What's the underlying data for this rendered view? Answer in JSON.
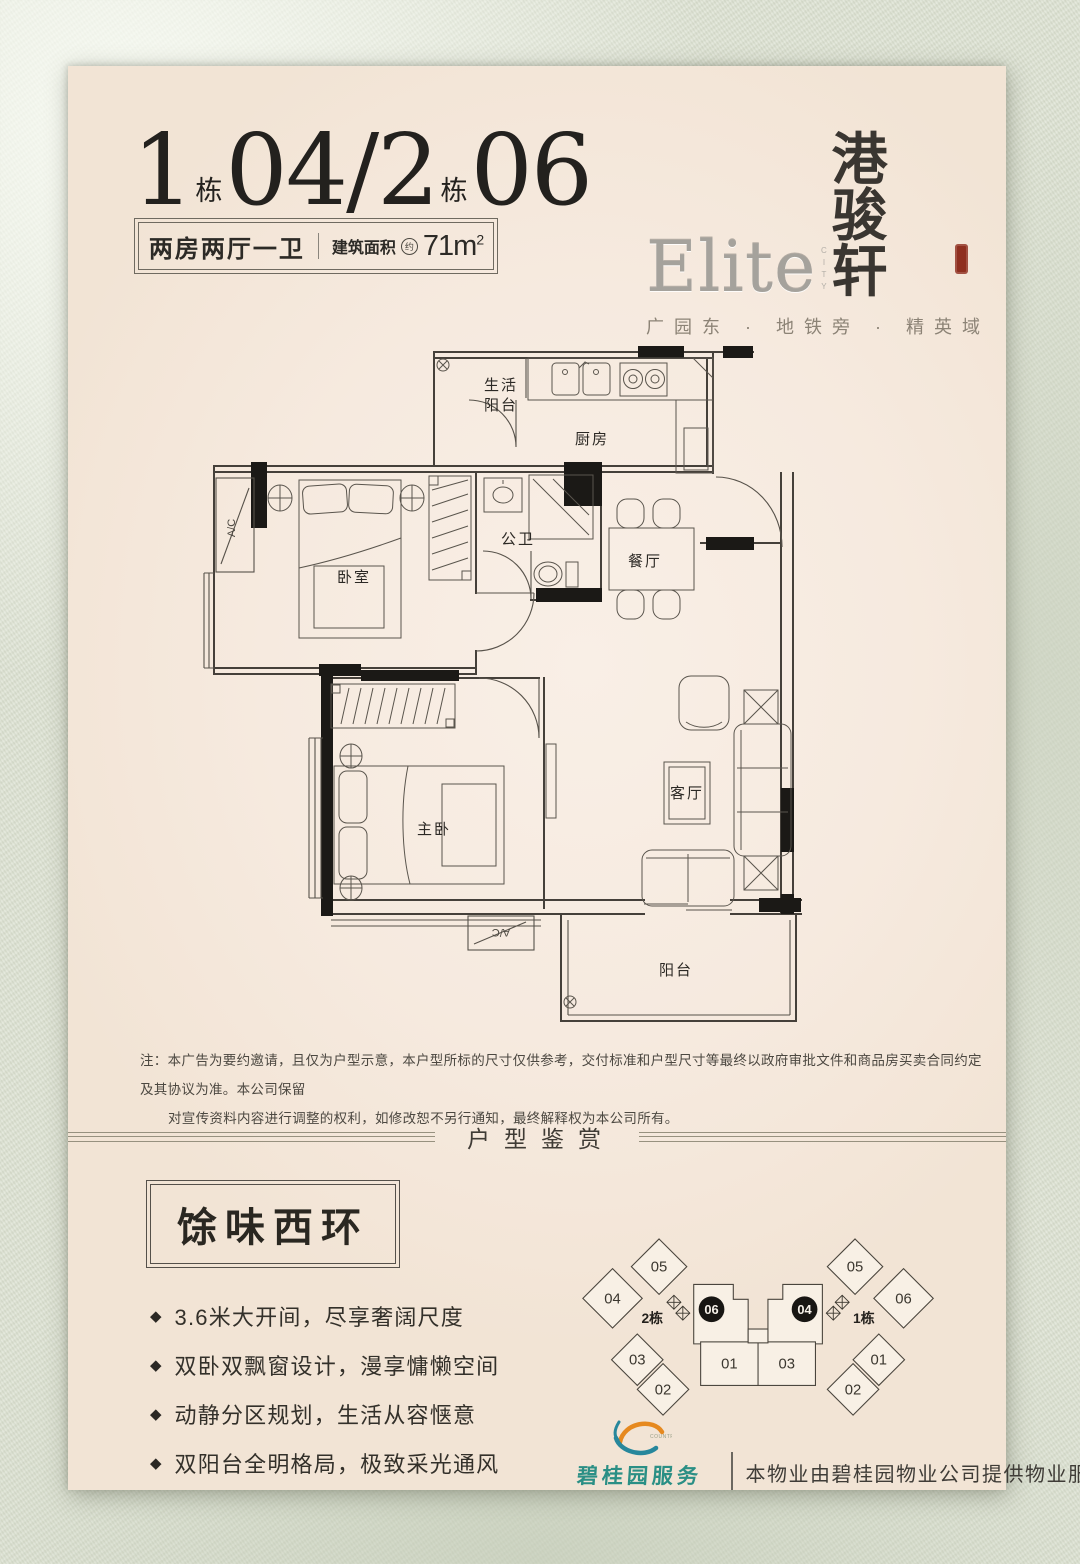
{
  "colors": {
    "page_cream": "#f8efe4",
    "fabric_green": "#dde2d2",
    "ink": "#2b2824",
    "seal_red": "#8e2f1f",
    "brand_teal": "#2b8f85",
    "wall_black": "#1b1916"
  },
  "header": {
    "title": {
      "b1_num": "1",
      "b1_unit": "栋",
      "b1_code": "04",
      "slash": "/",
      "b2_num": "2",
      "b2_unit": "栋",
      "b2_code": "06"
    },
    "spec": {
      "layout": "两房两厅一卫",
      "area_label": "建筑面积",
      "area_approx": "约",
      "area_value": "71m",
      "area_sup": "2"
    },
    "brand": {
      "latin": "Elite",
      "latin_sub": "CITY",
      "cn": "港骏轩",
      "tagline": "广园东 · 地铁旁 · 精英域"
    }
  },
  "floorplan": {
    "rooms": {
      "service_balcony_l1": "生活",
      "service_balcony_l2": "阳台",
      "kitchen": "厨房",
      "bath": "公卫",
      "dining": "餐厅",
      "bedroom": "卧室",
      "master": "主卧",
      "living": "客厅",
      "balcony": "阳台",
      "ac": "A/C"
    }
  },
  "disclaimer": {
    "line1": "注：本广告为要约邀请，且仅为户型示意，本户型所标的尺寸仅供参考，交付标准和户型尺寸等最终以政府审批文件和商品房买卖合同约定及其协议为准。本公司保留",
    "line2": "对宣传资料内容进行调整的权利，如修改恕不另行通知，最终解释权为本公司所有。"
  },
  "section": {
    "title": "户型鉴赏"
  },
  "selling": {
    "title": "馀味西环",
    "bullet": "◆",
    "points": [
      "3.6米大开间，尽享奢阔尺度",
      "双卧双飘窗设计，漫享慵懒空间",
      "动静分区规划，生活从容惬意",
      "双阳台全明格局，极致采光通风"
    ]
  },
  "keyplan": {
    "left_label": "2栋",
    "right_label": "1栋",
    "left_badge": "06",
    "right_badge": "04",
    "left_units": {
      "u05": "05",
      "u04": "04",
      "u03": "03",
      "u02": "02",
      "u01": "01"
    },
    "right_units": {
      "u05": "05",
      "u06": "06",
      "u01": "01",
      "u02": "02",
      "u03": "03"
    }
  },
  "footer": {
    "brand": "碧桂园服务",
    "brand_sub": "COUNTRY GARDEN",
    "note": "本物业由碧桂园物业公司提供物业服务"
  }
}
